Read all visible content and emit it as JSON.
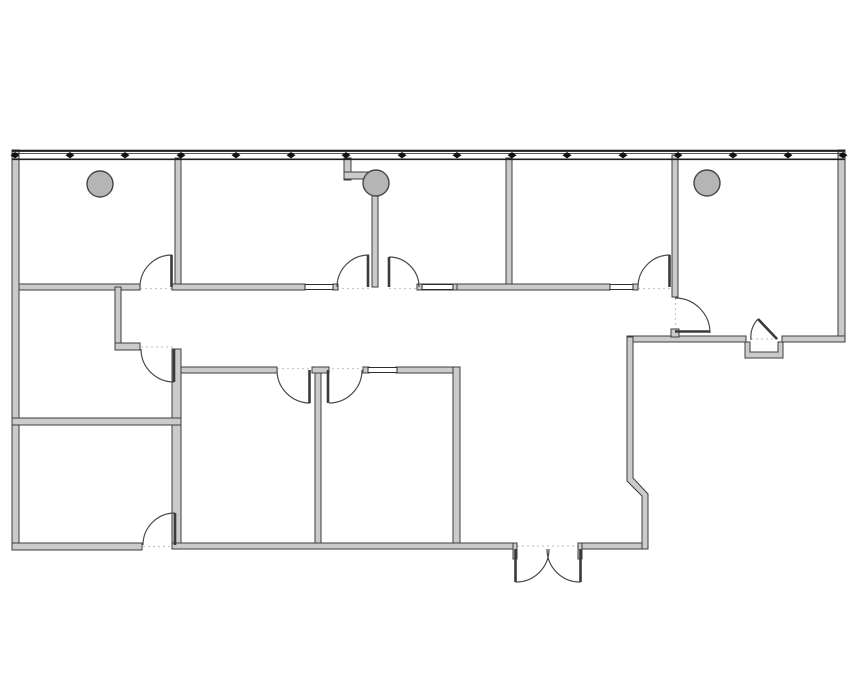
{
  "meta": {
    "title": "office-suite-floor-plan",
    "canvas": {
      "width": 855,
      "height": 678
    },
    "background": "#ffffff"
  },
  "style": {
    "wall_fill": "#cbcbcb",
    "wall_stroke": "#3d3d3d",
    "wall_stroke_width": 1,
    "door_leaf_color": "#3a3a3a",
    "door_leaf_width": 2.6,
    "door_arc_color": "#4a4a4a",
    "door_arc_width": 1.2,
    "threshold_color": "#cfc6bd",
    "threshold_dash": "2 3",
    "glazing_fill": "#ffffff",
    "glazing_stroke": "#2e2e2e",
    "column_fill": "#b5b5b5",
    "column_stroke": "#454545",
    "window_line_color": "#1f1f1f",
    "mullion_color": "#111111"
  },
  "window_wall": {
    "x1": 12,
    "x2": 845,
    "outer_y": 150.8,
    "outer_w": 2.2,
    "mid_y": 153.4,
    "mid_w": 0.8,
    "inner_y": 159.3,
    "inner_w": 1.6,
    "mullion_y": 155.2,
    "mullion_half_w": 4.5,
    "mullion_half_h": 3.2,
    "mullion_xs": [
      15,
      70,
      125,
      181,
      236,
      291,
      346,
      402,
      457,
      512,
      567,
      623,
      678,
      733,
      788,
      843
    ]
  },
  "walls": [
    {
      "name": "exterior-wall-west",
      "x": 12,
      "y": 150,
      "w": 7,
      "h": 400
    },
    {
      "name": "exterior-wall-east",
      "x": 838,
      "y": 150,
      "w": 7,
      "h": 192
    },
    {
      "name": "exterior-wall-south-left",
      "x": 12,
      "y": 543,
      "w": 130,
      "h": 7
    },
    {
      "name": "exterior-wall-south-mid",
      "x": 172,
      "y": 543,
      "w": 341,
      "h": 6
    },
    {
      "name": "exterior-wall-south-right",
      "x": 582,
      "y": 543,
      "w": 66,
      "h": 6
    },
    {
      "name": "reception-north-wall-a",
      "x": 627,
      "y": 336,
      "w": 119,
      "h": 6
    },
    {
      "name": "reception-north-wall-b",
      "x": 782,
      "y": 336,
      "w": 63,
      "h": 6
    },
    {
      "name": "partition-office1-office2",
      "x": 175,
      "y": 158,
      "w": 6,
      "h": 129
    },
    {
      "name": "partition-office3-office4",
      "x": 506,
      "y": 158,
      "w": 6,
      "h": 129
    },
    {
      "name": "partition-office4-office5",
      "x": 672,
      "y": 155,
      "w": 6,
      "h": 142
    },
    {
      "name": "partition-column-divider",
      "x": 372,
      "y": 190,
      "w": 6,
      "h": 97
    },
    {
      "name": "column-stub-vertical",
      "x": 344,
      "y": 158,
      "w": 7,
      "h": 22
    },
    {
      "name": "column-stub-horizontal",
      "x": 344,
      "y": 172,
      "w": 26,
      "h": 7
    },
    {
      "name": "corridor-wall-seg1",
      "x": 19,
      "y": 284,
      "w": 121,
      "h": 6
    },
    {
      "name": "corridor-wall-seg2",
      "x": 172,
      "y": 284,
      "w": 133,
      "h": 6
    },
    {
      "name": "corridor-wall-jamb1",
      "x": 333,
      "y": 284,
      "w": 5,
      "h": 6
    },
    {
      "name": "corridor-wall-seg3",
      "x": 417,
      "y": 284,
      "w": 40,
      "h": 6
    },
    {
      "name": "corridor-wall-seg4",
      "x": 457,
      "y": 284,
      "w": 153,
      "h": 6
    },
    {
      "name": "corridor-wall-jamb2",
      "x": 633,
      "y": 284,
      "w": 5,
      "h": 6
    },
    {
      "name": "office5-door-jamb",
      "x": 671,
      "y": 329,
      "w": 8,
      "h": 8
    },
    {
      "name": "left-wing-nook-wall",
      "x": 115,
      "y": 287,
      "w": 6,
      "h": 62
    },
    {
      "name": "left-wing-nook-stub",
      "x": 115,
      "y": 343,
      "w": 25,
      "h": 7
    },
    {
      "name": "left-wing-east-wall",
      "x": 172,
      "y": 349,
      "w": 9,
      "h": 194
    },
    {
      "name": "left-wing-mid-wall",
      "x": 12,
      "y": 418,
      "w": 169,
      "h": 7
    },
    {
      "name": "block-north-wall-a",
      "x": 181,
      "y": 367,
      "w": 96,
      "h": 6
    },
    {
      "name": "block-north-wall-cap",
      "x": 312,
      "y": 367,
      "w": 17,
      "h": 6
    },
    {
      "name": "block-north-wall-jamb",
      "x": 363,
      "y": 367,
      "w": 6,
      "h": 6
    },
    {
      "name": "block-north-wall-b",
      "x": 396,
      "y": 367,
      "w": 64,
      "h": 6
    },
    {
      "name": "block-divider-wall",
      "x": 315,
      "y": 373,
      "w": 6,
      "h": 170
    },
    {
      "name": "block-east-wall",
      "x": 453,
      "y": 367,
      "w": 7,
      "h": 176
    },
    {
      "name": "exit-door-jamb-left",
      "x": 513,
      "y": 543,
      "w": 4,
      "h": 16
    },
    {
      "name": "exit-door-jamb-right",
      "x": 578,
      "y": 543,
      "w": 4,
      "h": 16
    }
  ],
  "polywalls": [
    {
      "name": "lobby-jog-wall",
      "points": "627,337 633,337 633,478 648,494 648,549 642,549 642,496 627,481"
    },
    {
      "name": "entry-alcove-wall",
      "points": "745,342 745,358 783,358 783,342 778,342 778,352 750,352 750,342"
    }
  ],
  "glazings": [
    {
      "name": "sidelight-corridor-1",
      "x": 305,
      "y": 284.5,
      "w": 28,
      "h": 5
    },
    {
      "name": "sidelight-corridor-2",
      "x": 422,
      "y": 284.5,
      "w": 31,
      "h": 5
    },
    {
      "name": "sidelight-corridor-3",
      "x": 610,
      "y": 284.5,
      "w": 23,
      "h": 5
    },
    {
      "name": "sidelight-block",
      "x": 368,
      "y": 367.5,
      "w": 29,
      "h": 5
    }
  ],
  "columns": [
    {
      "name": "structural-column-1",
      "cx": 100,
      "cy": 184,
      "r": 13
    },
    {
      "name": "structural-column-2",
      "cx": 376,
      "cy": 183,
      "r": 13
    },
    {
      "name": "structural-column-3",
      "cx": 707,
      "cy": 183,
      "r": 13
    }
  ],
  "door_leaves": [
    {
      "name": "door-leaf-office1",
      "x1": 171.5,
      "y1": 255,
      "x2": 171.5,
      "y2": 287
    },
    {
      "name": "door-leaf-office2",
      "x1": 368,
      "y1": 255,
      "x2": 368,
      "y2": 287
    },
    {
      "name": "door-leaf-office3",
      "x1": 389,
      "y1": 257,
      "x2": 389,
      "y2": 287
    },
    {
      "name": "door-leaf-office4",
      "x1": 669.5,
      "y1": 255,
      "x2": 669.5,
      "y2": 287
    },
    {
      "name": "door-leaf-office5",
      "x1": 675,
      "y1": 331.5,
      "x2": 710,
      "y2": 331.5
    },
    {
      "name": "door-leaf-room-west",
      "x1": 174,
      "y1": 349,
      "x2": 174,
      "y2": 382
    },
    {
      "name": "door-leaf-room-sw",
      "x1": 175,
      "y1": 513,
      "x2": 175,
      "y2": 545
    },
    {
      "name": "door-leaf-block-left",
      "x1": 309.5,
      "y1": 370,
      "x2": 309.5,
      "y2": 403
    },
    {
      "name": "door-leaf-block-right",
      "x1": 328,
      "y1": 370,
      "x2": 328,
      "y2": 403
    },
    {
      "name": "door-leaf-exit-left",
      "x1": 515.5,
      "y1": 549,
      "x2": 515.5,
      "y2": 582
    },
    {
      "name": "door-leaf-exit-right",
      "x1": 580.5,
      "y1": 549,
      "x2": 580.5,
      "y2": 582
    },
    {
      "name": "door-leaf-entry-angled",
      "x1": 777,
      "y1": 339,
      "x2": 758,
      "y2": 319
    }
  ],
  "door_arcs": [
    {
      "name": "door-arc-office1",
      "d": "M 140,287 A 32 32 0 0 1 172,255"
    },
    {
      "name": "door-arc-office2",
      "d": "M 337,287 A 32 32 0 0 1 369,255"
    },
    {
      "name": "door-arc-office3",
      "d": "M 389,257 A 30 30 0 0 1 419,287"
    },
    {
      "name": "door-arc-office4",
      "d": "M 638,287 A 32 32 0 0 1 670,255"
    },
    {
      "name": "door-arc-office5",
      "d": "M 675,298 A 35 35 0 0 1 710,333"
    },
    {
      "name": "door-arc-room-west",
      "d": "M 141,349 A 33 33 0 0 0 174,382"
    },
    {
      "name": "door-arc-room-sw",
      "d": "M 143,545 A 32 32 0 0 1 175,513"
    },
    {
      "name": "door-arc-block-left",
      "d": "M 277,370 A 33 33 0 0 0 310,403"
    },
    {
      "name": "door-arc-block-right",
      "d": "M 329,403 A 33 33 0 0 0 362,370"
    },
    {
      "name": "door-arc-exit-left",
      "d": "M 515.5,582 A 33 33 0 0 0 549,549"
    },
    {
      "name": "door-arc-exit-right",
      "d": "M 547,549 A 33 33 0 0 0 580.5,582"
    },
    {
      "name": "door-arc-entry-angled",
      "d": "M 758,319 A 27 27 0 0 0 751,340"
    }
  ],
  "thresholds": [
    {
      "name": "threshold-office1",
      "x1": 140,
      "y1": 288.5,
      "x2": 172,
      "y2": 288.5
    },
    {
      "name": "threshold-office2",
      "x1": 337,
      "y1": 288.5,
      "x2": 369,
      "y2": 288.5
    },
    {
      "name": "threshold-office3",
      "x1": 389,
      "y1": 288.5,
      "x2": 417,
      "y2": 288.5
    },
    {
      "name": "threshold-office4",
      "x1": 638,
      "y1": 288.5,
      "x2": 670,
      "y2": 288.5
    },
    {
      "name": "threshold-office5",
      "x1": 675.5,
      "y1": 298,
      "x2": 675.5,
      "y2": 330
    },
    {
      "name": "threshold-room-west",
      "x1": 141,
      "y1": 347,
      "x2": 173,
      "y2": 347
    },
    {
      "name": "threshold-room-sw",
      "x1": 143,
      "y1": 546.5,
      "x2": 175,
      "y2": 546.5
    },
    {
      "name": "threshold-block-doors",
      "x1": 277,
      "y1": 368.5,
      "x2": 362,
      "y2": 368.5
    },
    {
      "name": "threshold-entry",
      "x1": 751,
      "y1": 339,
      "x2": 778,
      "y2": 339
    },
    {
      "name": "threshold-exit",
      "x1": 517,
      "y1": 546,
      "x2": 578,
      "y2": 546
    }
  ]
}
